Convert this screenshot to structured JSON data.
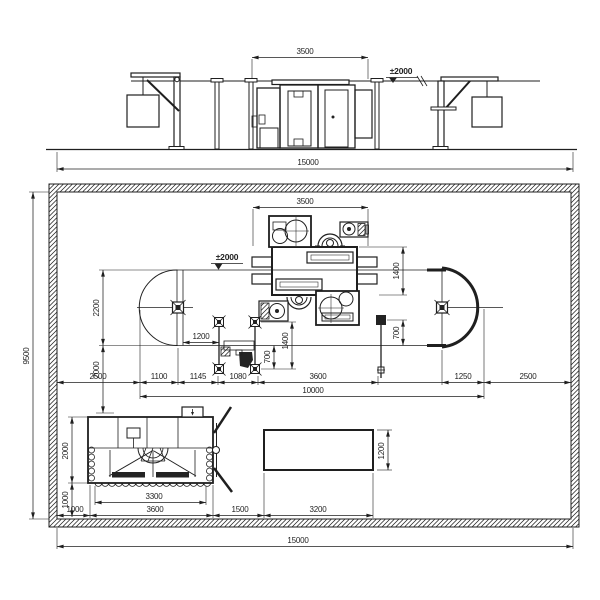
{
  "colors": {
    "line": "#1f1f1f",
    "background": "#ffffff",
    "fill_dark": "#232323"
  },
  "elevation": {
    "dim_width_3500": "3500",
    "datum_level": "±2000",
    "dim_overall_15000": "15000"
  },
  "plan": {
    "dim_width_3500": "3500",
    "datum_level": "±2000",
    "dim_machine_depth_1400": "1400",
    "dim_track_right_700": "700",
    "dim_mid_1400": "1400",
    "dim_mid_700": "700",
    "dim_1200": "1200",
    "dim_left_2200": "2200",
    "dim_left_2000": "2000",
    "dim_overall_height_9500": "9500",
    "chain": {
      "left_2500": "2500",
      "d_1100": "1100",
      "d_1145": "1145",
      "d_1080": "1080",
      "d_3600": "3600",
      "d_1250": "1250",
      "right_2500": "2500",
      "total_10000": "10000"
    },
    "tank": {
      "height_2000": "2000",
      "depth_1000": "1000",
      "width_3300": "3300",
      "width_3600": "3600",
      "offset_1000": "1000",
      "gap_1500": "1500"
    },
    "pit": {
      "width_3200": "3200",
      "height_1200": "1200"
    },
    "dim_overall_15000": "15000"
  }
}
